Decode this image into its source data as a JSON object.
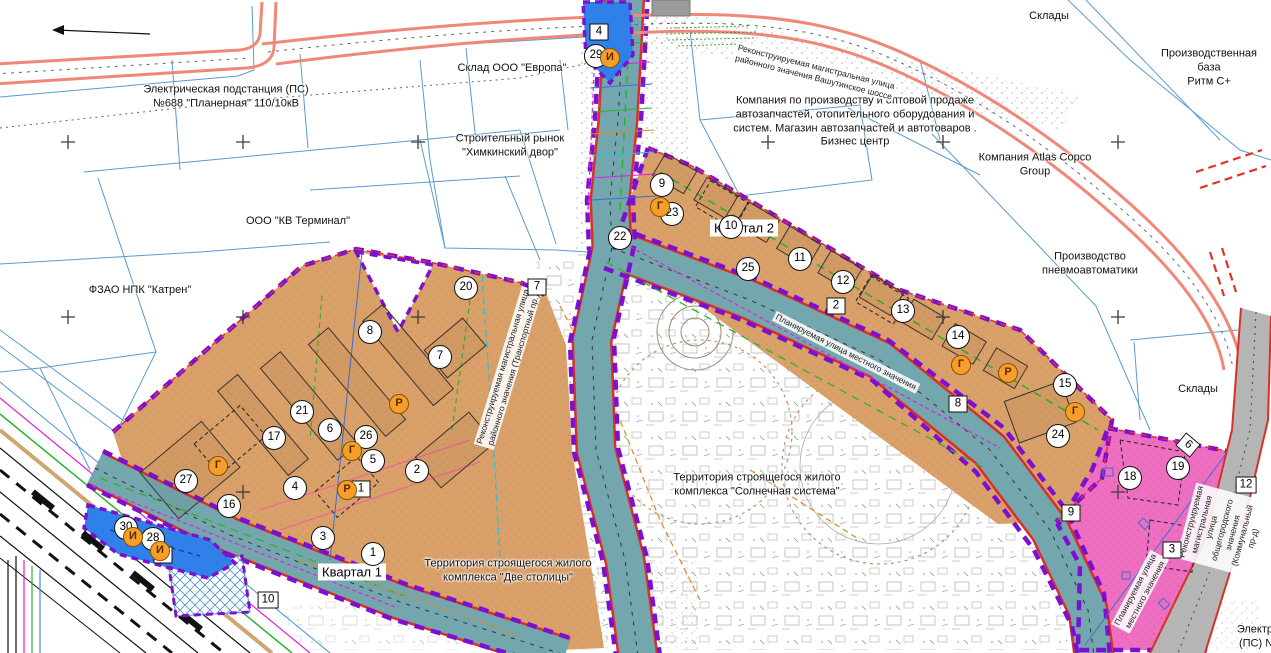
{
  "map": {
    "colors": {
      "orange_zone": "#d9a069",
      "pink_zone": "#ee6fc0",
      "road_teal": "#74a6ae",
      "road_salmon": "#f08878",
      "road_gray": "#b5b5b5",
      "boundary_purple": "#7d10d0",
      "parcel_blue": "#4a90c8",
      "marker_orange": "#f59f2a"
    },
    "area_labels": [
      {
        "text": "Электрическая подстанция (ПС)\n№688 \"Планерная\" 110/10кВ",
        "x": 226,
        "y": 97
      },
      {
        "text": "Склад ООО \"Европа\"",
        "x": 512,
        "y": 69
      },
      {
        "text": "Строительный рынок\n\"Химкинский двор\"",
        "x": 510,
        "y": 146
      },
      {
        "text": "ООО \"КВ Терминал\"",
        "x": 298,
        "y": 222
      },
      {
        "text": "ФЗАО НПК \"Катрен\"",
        "x": 140,
        "y": 291
      },
      {
        "text": "Склады",
        "x": 1049,
        "y": 17
      },
      {
        "text": "Производственная база\nРитм С+",
        "x": 1209,
        "y": 68
      },
      {
        "text": "Компания по производству и оптовой продаже\nавтозапчастей, отопительного оборудования и\nсистем. Магазин автозапчастей и автотоваров .\nБизнес центр",
        "x": 855,
        "y": 122
      },
      {
        "text": "Компания Atlas Copco\nGroup",
        "x": 1035,
        "y": 165
      },
      {
        "text": "Производство\nпневмоавтоматики",
        "x": 1090,
        "y": 264
      },
      {
        "text": "Склады",
        "x": 1198,
        "y": 390
      },
      {
        "text": "Территория строящегося жилого\nкомплекса \"Солнечная система\"",
        "x": 757,
        "y": 485
      },
      {
        "text": "Территория строящегося жилого\nкомплекса \"Две столицы\"",
        "x": 508,
        "y": 571
      },
      {
        "text": "Электри\n(ПС) №",
        "x": 1258,
        "y": 637
      }
    ],
    "quarter_labels": [
      {
        "text": "Квартал 1",
        "x": 352,
        "y": 572
      },
      {
        "text": "Квартал 2",
        "x": 744,
        "y": 228
      }
    ],
    "road_labels": [
      {
        "text": "Реконструируемая магистральная улица\nрайонного значения Вашутинское шоссе",
        "x": 815,
        "y": 72,
        "rot": 14
      },
      {
        "text": "Реконструируемая магистральная улица\nрайонного значения (Транспортный пр.)",
        "x": 508,
        "y": 368,
        "rot": -73
      },
      {
        "text": "Планируемая улица местного значения",
        "x": 846,
        "y": 352,
        "rot": 27
      },
      {
        "text": "Планируемая улица\nместного значения",
        "x": 1140,
        "y": 592,
        "rot": -62
      },
      {
        "text": "Реконструируемая магистральная улица\nобщегородского значения (Коммунальный пр-д)",
        "x": 1222,
        "y": 530,
        "rot": -75
      }
    ],
    "circle_markers": [
      {
        "label": "29",
        "x": 596,
        "y": 56
      },
      {
        "label": "9",
        "x": 662,
        "y": 185
      },
      {
        "label": "23",
        "x": 672,
        "y": 214
      },
      {
        "label": "22",
        "x": 620,
        "y": 238
      },
      {
        "label": "10",
        "x": 731,
        "y": 227
      },
      {
        "label": "25",
        "x": 748,
        "y": 269
      },
      {
        "label": "11",
        "x": 800,
        "y": 259
      },
      {
        "label": "12",
        "x": 843,
        "y": 282
      },
      {
        "label": "13",
        "x": 903,
        "y": 311
      },
      {
        "label": "14",
        "x": 958,
        "y": 337
      },
      {
        "label": "15",
        "x": 1065,
        "y": 385
      },
      {
        "label": "24",
        "x": 1058,
        "y": 436
      },
      {
        "label": "19",
        "x": 1178,
        "y": 468
      },
      {
        "label": "18",
        "x": 1130,
        "y": 478
      },
      {
        "label": "20",
        "x": 466,
        "y": 288
      },
      {
        "label": "8",
        "x": 370,
        "y": 332
      },
      {
        "label": "7",
        "x": 440,
        "y": 357
      },
      {
        "label": "21",
        "x": 302,
        "y": 412
      },
      {
        "label": "17",
        "x": 274,
        "y": 438
      },
      {
        "label": "6",
        "x": 330,
        "y": 430
      },
      {
        "label": "26",
        "x": 366,
        "y": 437
      },
      {
        "label": "5",
        "x": 373,
        "y": 461
      },
      {
        "label": "2",
        "x": 417,
        "y": 471
      },
      {
        "label": "4",
        "x": 295,
        "y": 488
      },
      {
        "label": "27",
        "x": 186,
        "y": 481
      },
      {
        "label": "16",
        "x": 229,
        "y": 506
      },
      {
        "label": "3",
        "x": 323,
        "y": 538
      },
      {
        "label": "1",
        "x": 373,
        "y": 554
      },
      {
        "label": "30",
        "x": 126,
        "y": 528
      },
      {
        "label": "28",
        "x": 153,
        "y": 539
      }
    ],
    "square_markers": [
      {
        "label": "4",
        "x": 599,
        "y": 32,
        "rot": 0
      },
      {
        "label": "7",
        "x": 537,
        "y": 287,
        "rot": 0
      },
      {
        "label": "2",
        "x": 836,
        "y": 306,
        "rot": 0
      },
      {
        "label": "8",
        "x": 958,
        "y": 404,
        "rot": 0
      },
      {
        "label": "9",
        "x": 1071,
        "y": 513,
        "rot": 0
      },
      {
        "label": "12",
        "x": 1246,
        "y": 485,
        "rot": 0
      },
      {
        "label": "3",
        "x": 1172,
        "y": 550,
        "rot": 0
      },
      {
        "label": "5",
        "x": 163,
        "y": 555,
        "rot": 0
      },
      {
        "label": "10",
        "x": 268,
        "y": 600,
        "rot": 0
      },
      {
        "label": "1",
        "x": 361,
        "y": 489,
        "rot": 0
      },
      {
        "label": "6",
        "x": 1188,
        "y": 445,
        "rot": 40
      }
    ],
    "letter_markers": [
      {
        "label": "И",
        "x": 610,
        "y": 58
      },
      {
        "label": "Г",
        "x": 660,
        "y": 207
      },
      {
        "label": "Г",
        "x": 961,
        "y": 365
      },
      {
        "label": "Р",
        "x": 1008,
        "y": 373
      },
      {
        "label": "Г",
        "x": 1075,
        "y": 412
      },
      {
        "label": "Г",
        "x": 218,
        "y": 466
      },
      {
        "label": "Г",
        "x": 352,
        "y": 451
      },
      {
        "label": "Р",
        "x": 399,
        "y": 404
      },
      {
        "label": "Р",
        "x": 347,
        "y": 490
      },
      {
        "label": "И",
        "x": 133,
        "y": 537
      },
      {
        "label": "И",
        "x": 160,
        "y": 551
      }
    ]
  }
}
